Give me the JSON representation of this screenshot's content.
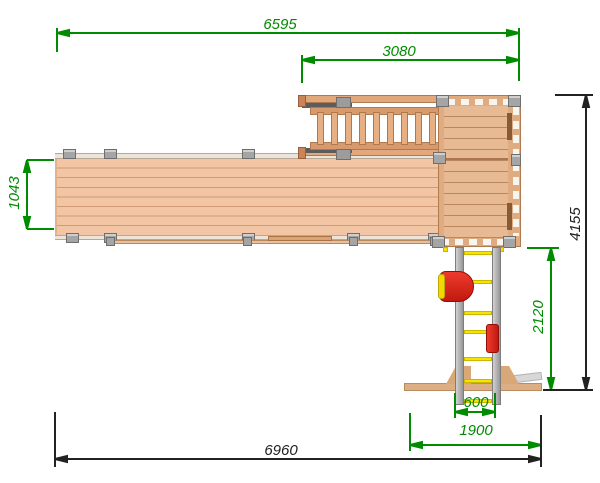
{
  "drawing": {
    "dimension_labels": {
      "overall_top": "6595",
      "stairs_section": "3080",
      "ramp_width": "1043",
      "overall_depth": "4155",
      "swing_depth": "2120",
      "swing_inner_width": "600",
      "swing_base_width": "1900",
      "overall_bottom": "6960"
    },
    "colors": {
      "dimension_green": "#008b00",
      "dimension_dark": "#222222",
      "wood_light": "#f2c6a4",
      "wood_medium": "#dfab80",
      "metal_gray": "#a5a5a5",
      "swing_yellow": "#f8e300",
      "swing_red": "#e1261d"
    }
  }
}
